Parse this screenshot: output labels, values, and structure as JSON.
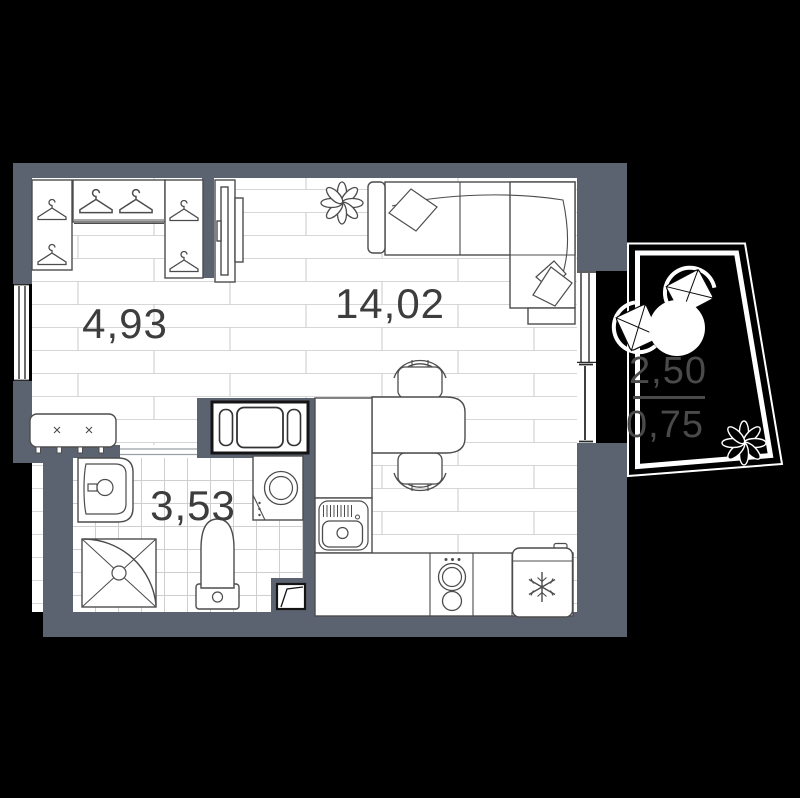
{
  "plan": {
    "type": "studio apartment floor plan",
    "rooms": [
      {
        "name": "hallway",
        "area": "4,93"
      },
      {
        "name": "living-kitchen",
        "area": "14,02"
      },
      {
        "name": "bathroom",
        "area": "3,53"
      }
    ],
    "balcony": {
      "area": "2,50",
      "area_reduced": "0,75"
    }
  },
  "colors": {
    "background": "#000000",
    "wall": "#5c6370",
    "floor_line": "#d7d7d7",
    "tile_line": "#cfcfcf",
    "furniture_outline": "#4c4c4c",
    "room_label": "#3d3d3d",
    "balcony_label": "#4a4a4a",
    "balcony_border": "#ffffff"
  },
  "icons": [
    "hanger-icon",
    "tv-icon",
    "plant-icon",
    "sofa-icon",
    "pillow-icon",
    "bench-icon",
    "hall-cabinet-icon",
    "washbasin-icon",
    "shower-icon",
    "toilet-icon",
    "washing-machine-icon",
    "kitchen-sink-icon",
    "stove-icon",
    "fridge-icon",
    "dining-table-icon",
    "chair-icon",
    "balcony-table-icon",
    "balcony-chair-icon",
    "balcony-plant-icon",
    "window-icon",
    "balcony-door-icon",
    "vent-icon"
  ]
}
